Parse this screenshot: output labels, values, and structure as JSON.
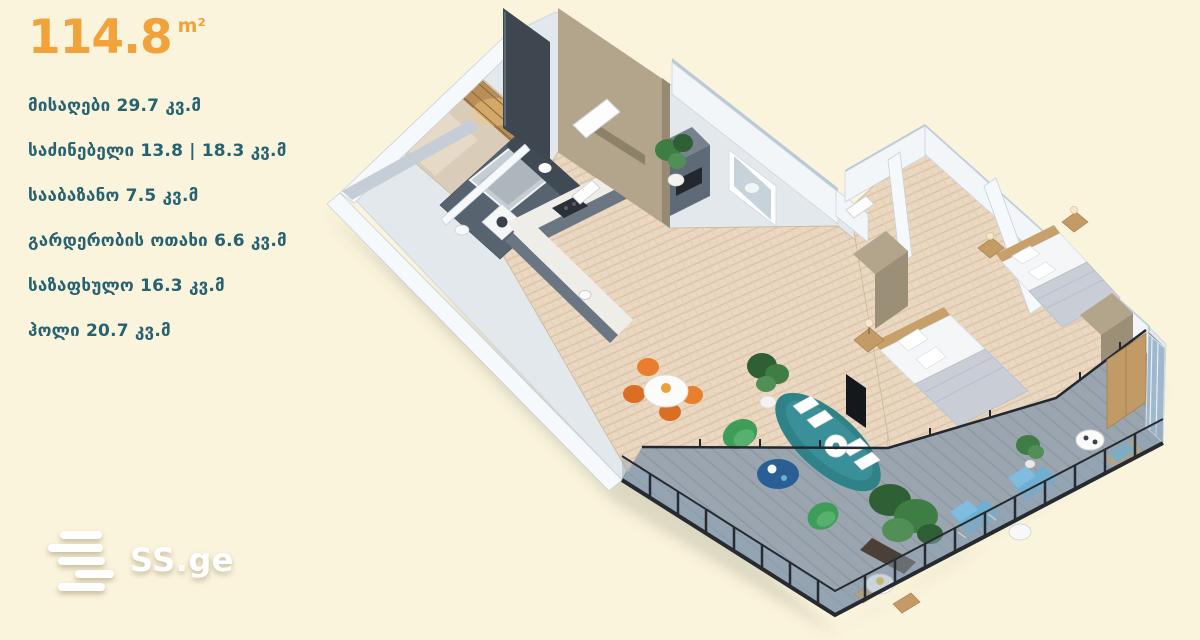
{
  "header": {
    "area_value": "114.8",
    "area_unit": "m²"
  },
  "rooms": [
    {
      "label": "მისაღები 29.7 კვ.მ"
    },
    {
      "label": "საძინებელი 13.8 | 18.3 კვ.მ"
    },
    {
      "label": "სააბაზანო 7.5 კვ.მ"
    },
    {
      "label": "გარდერობის ოთახი 6.6 კვ.მ"
    },
    {
      "label": "საზაფხულო 16.3 კვ.მ"
    },
    {
      "label": "ჰოლი 20.7 კვ.მ"
    }
  ],
  "watermark": {
    "text": "SS.ge"
  },
  "colors": {
    "background": "#FBF4DC",
    "accent_orange": "#F2A23A",
    "label_teal": "#266271",
    "watermark_white": "#FFFFFF",
    "wall_white": "#F6F9FB",
    "parquet_wood": "#EAD8C2",
    "bathroom_slate": "#57636E",
    "sofa_teal": "#2F8388",
    "chair_green": "#3E9D58",
    "chair_orange": "#E87E2E",
    "terrace_deck": "#9AA5AF",
    "railing_dark": "#262B31",
    "balcony_glass_blue": "#9FBCD4",
    "wardrobe_tan": "#B3A48C"
  }
}
